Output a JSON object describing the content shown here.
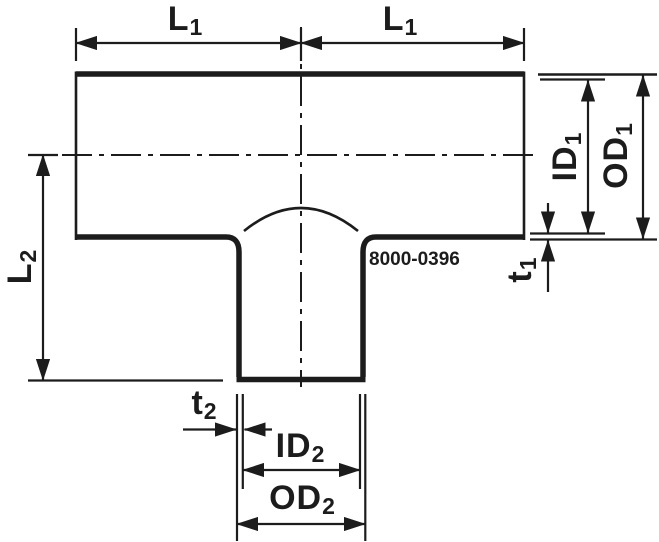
{
  "diagram": {
    "type": "technical-drawing",
    "subject": "reducing-tee-pipe-fitting",
    "part_number": "8000-0396",
    "colors": {
      "line": "#1c1c1c",
      "background": "#ffffff"
    },
    "labels": {
      "l1_left": {
        "main": "L",
        "sub": "1"
      },
      "l1_right": {
        "main": "L",
        "sub": "1"
      },
      "l2": {
        "main": "L",
        "sub": "2"
      },
      "id1": {
        "main": "ID",
        "sub": "1"
      },
      "od1": {
        "main": "OD",
        "sub": "1"
      },
      "t1": {
        "main": "t",
        "sub": "1"
      },
      "t2": {
        "main": "t",
        "sub": "2"
      },
      "id2": {
        "main": "ID",
        "sub": "2"
      },
      "od2": {
        "main": "OD",
        "sub": "2"
      }
    }
  }
}
